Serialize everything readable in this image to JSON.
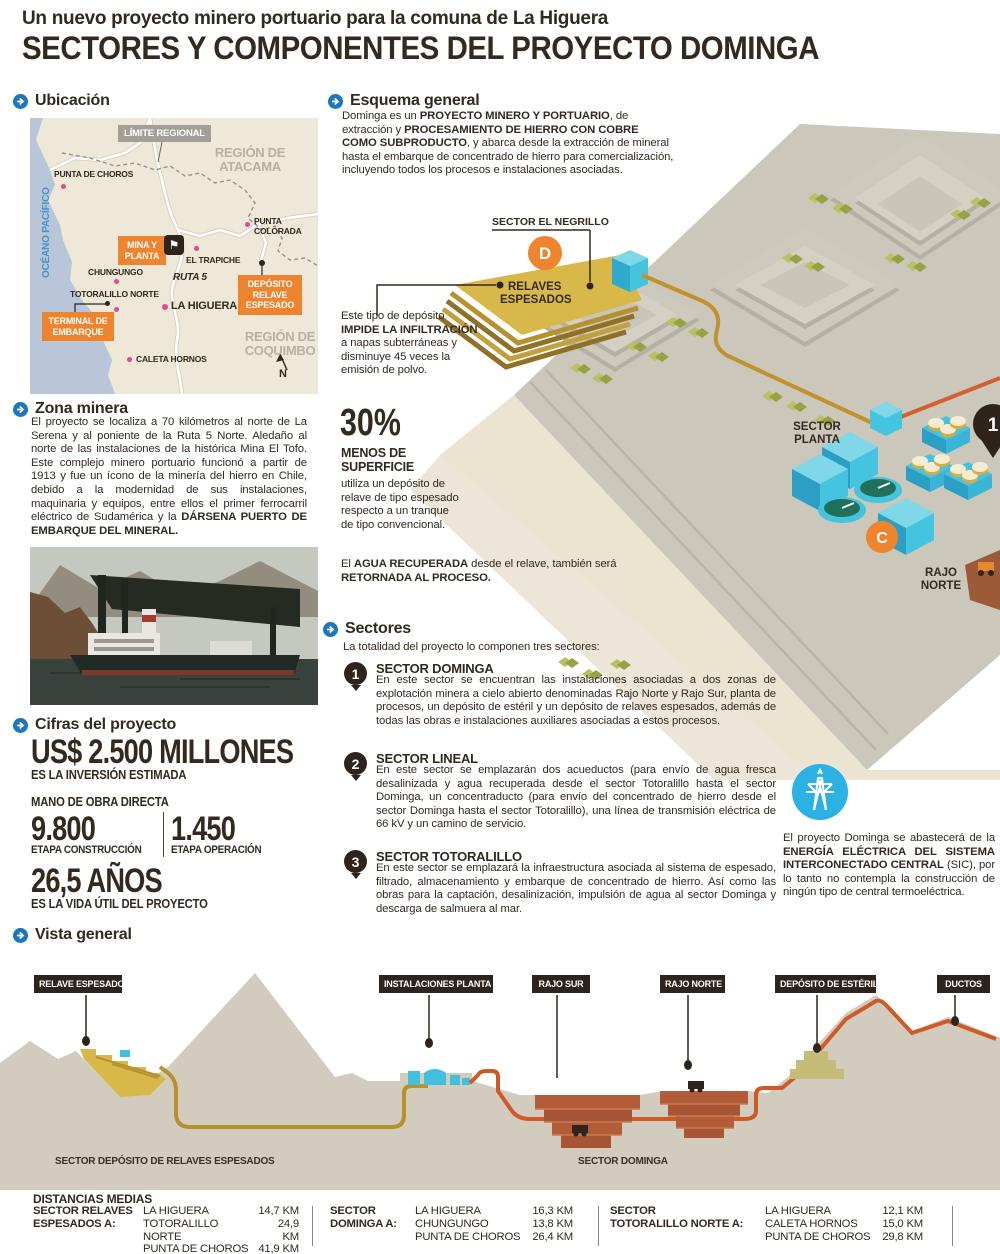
{
  "header": {
    "kicker": "Un nuevo proyecto minero portuario para la comuna de La Higuera",
    "title": "SECTORES Y COMPONENTES DEL PROYECTO DOMINGA"
  },
  "ubicacion": {
    "heading": "Ubicación",
    "map": {
      "limite_regional": "LÍMITE REGIONAL",
      "region_atacama_1": "REGIÓN DE",
      "region_atacama_2": "ATACAMA",
      "punta_de_choros": "PUNTA DE CHOROS",
      "oceano_pacifico": "OCÉANO PACÍFICO",
      "mina_y_planta_1": "MINA Y",
      "mina_y_planta_2": "PLANTA",
      "el_trapiche": "EL TRAPICHE",
      "punta_colorada_1": "PUNTA",
      "punta_colorada_2": "COLORADA",
      "ruta_5": "RUTA 5",
      "chungungo": "CHUNGUNGO",
      "totoralillo_norte": "TOTORALILLO NORTE",
      "la_higuera": "LA HIGUERA",
      "deposito_1": "DEPÓSITO",
      "deposito_2": "RELAVE",
      "deposito_3": "ESPESADO",
      "terminal_1": "TERMINAL DE",
      "terminal_2": "EMBARQUE",
      "caleta_hornos": "CALETA HORNOS",
      "region_coquimbo_1": "REGIÓN DE",
      "region_coquimbo_2": "COQUIMBO",
      "north": "N"
    }
  },
  "zona_minera": {
    "heading": "Zona minera",
    "text": "El proyecto se localiza a 70 kilómetros al norte de La Serena y al poniente de la Ruta 5 Norte. Aledaño al norte de las instalaciones de la histórica Mina El Tofo. Este complejo minero portuario funcionó a partir de 1913 y fue un ícono de la minería del hierro en Chile, debido a la modernidad de sus instalaciones, maquinaria y equipos, entre ellos el primer ferrocarril eléctrico de Sudamérica y la ",
    "bold": "DÁRSENA PUERTO DE EMBARQUE DEL MINERAL."
  },
  "cifras": {
    "heading": "Cifras del proyecto",
    "investment_value": "US$ 2.500 MILLONES",
    "investment_label": "ES LA INVERSIÓN ESTIMADA",
    "labor_label": "MANO DE OBRA DIRECTA",
    "construction_value": "9.800",
    "construction_label": "ETAPA CONSTRUCCIÓN",
    "operation_value": "1.450",
    "operation_label": "ETAPA OPERACIÓN",
    "life_value": "26,5 AÑOS",
    "life_label": "ES LA VIDA ÚTIL DEL PROYECTO"
  },
  "esquema": {
    "heading": "Esquema general",
    "p": [
      "Dominga es un ",
      "PROYECTO MINERO Y PORTUARIO",
      ", de extracción y ",
      "PROCESAMIENTO DE HIERRO CON COBRE COMO SUBPRODUCTO",
      ", y abarca desde la extracción de mineral hasta el embarque de concentrado de hierro para comercialización, incluyendo todos los procesos e instalaciones asociadas."
    ]
  },
  "iso": {
    "sector_el_negrillo": "SECTOR EL NEGRILLO",
    "marker_d": "D",
    "relaves_1": "RELAVES",
    "relaves_2": "ESPESADOS",
    "sector_planta_1": "SECTOR",
    "sector_planta_2": "PLANTA",
    "marker_c": "C",
    "rajo_norte_1": "RAJO",
    "rajo_norte_2": "NORTE",
    "pin_1": "1"
  },
  "deposito": {
    "p": [
      "Este tipo de depósito ",
      "IMPIDE LA INFILTRACIÓN",
      " a napas subterráneas y disminuye 45 veces la emisión de polvo."
    ],
    "pct": "30%",
    "pct_bold": "MENOS DE SUPERFICIE",
    "pct_text": "utiliza un depósito de relave de tipo espesado respecto a un tranque de tipo convencional.",
    "agua": [
      "El ",
      "AGUA RECUPERADA",
      " desde el relave, también será ",
      "RETORNADA AL PROCESO."
    ]
  },
  "sectores": {
    "heading": "Sectores",
    "intro": "La totalidad del proyecto lo componen tres sectores:",
    "items": [
      {
        "num": "1",
        "title": "SECTOR DOMINGA",
        "text": "En este sector se encuentran las instalaciones asociadas a dos zonas de explotación minera a cielo abierto denominadas Rajo Norte y Rajo Sur, planta de procesos, un depósito de estéril y un depósito de relaves espesados, además de todas las obras e instalaciones auxiliares asociadas a estos procesos."
      },
      {
        "num": "2",
        "title": "SECTOR LINEAL",
        "text": "En este sector se emplazarán dos acueductos (para envío de agua fresca desalinizada y agua recuperada desde el sector Totoralillo hasta el sector Dominga, un concentraducto (para envío del concentrado de hierro desde el sector Dominga hasta el sector Totoralillo), una línea de transmisión eléctrica de 66 kV y un camino de servicio."
      },
      {
        "num": "3",
        "title": "SECTOR TOTORALILLO",
        "text": "En este sector se emplazará la infraestructura asociada al sistema de espesado, filtrado, almacenamiento y embarque de concentrado de hierro. Así como las obras para la captación, desalinización, impulsión de agua al sector Dominga y descarga de salmuera al mar."
      }
    ]
  },
  "energia": {
    "p": [
      "El proyecto Dominga se abastecerá de la ",
      "ENERGÍA ELÉCTRICA DEL SISTEMA INTERCONECTADO CENTRAL",
      " (SIC), por lo tanto no contempla la construcción de ningún tipo de central termoeléctrica."
    ]
  },
  "vista": {
    "heading": "Vista general",
    "labels": [
      "RELAVE ESPESADO",
      "INSTALACIONES PLANTA",
      "RAJO SUR",
      "RAJO NORTE",
      "DEPÓSITO DE ESTÉRIL",
      "DUCTOS"
    ],
    "sector_left": "SECTOR DEPÓSITO DE RELAVES ESPESADOS",
    "sector_right": "SECTOR DOMINGA"
  },
  "distancias": {
    "heading": "DISTANCIAS MEDIAS",
    "groups": [
      {
        "label1": "SECTOR RELAVES",
        "label2": "ESPESADOS A:",
        "rows": [
          {
            "place": "LA HIGUERA",
            "km": "14,7 KM"
          },
          {
            "place": "TOTORALILLO NORTE",
            "km": "24,9 KM"
          },
          {
            "place": "PUNTA DE CHOROS",
            "km": "41,9 KM"
          }
        ]
      },
      {
        "label1": "SECTOR",
        "label2": "DOMINGA A:",
        "rows": [
          {
            "place": "LA HIGUERA",
            "km": "16,3 KM"
          },
          {
            "place": "CHUNGUNGO",
            "km": "13,8 KM"
          },
          {
            "place": "PUNTA DE CHOROS",
            "km": "26,4 KM"
          }
        ]
      },
      {
        "label1": "SECTOR",
        "label2": "TOTORALILLO NORTE A:",
        "rows": [
          {
            "place": "LA HIGUERA",
            "km": "12,1 KM"
          },
          {
            "place": "CALETA HORNOS",
            "km": "15,0 KM"
          },
          {
            "place": "PUNTA DE CHOROS",
            "km": "29,8 KM"
          }
        ]
      }
    ]
  }
}
